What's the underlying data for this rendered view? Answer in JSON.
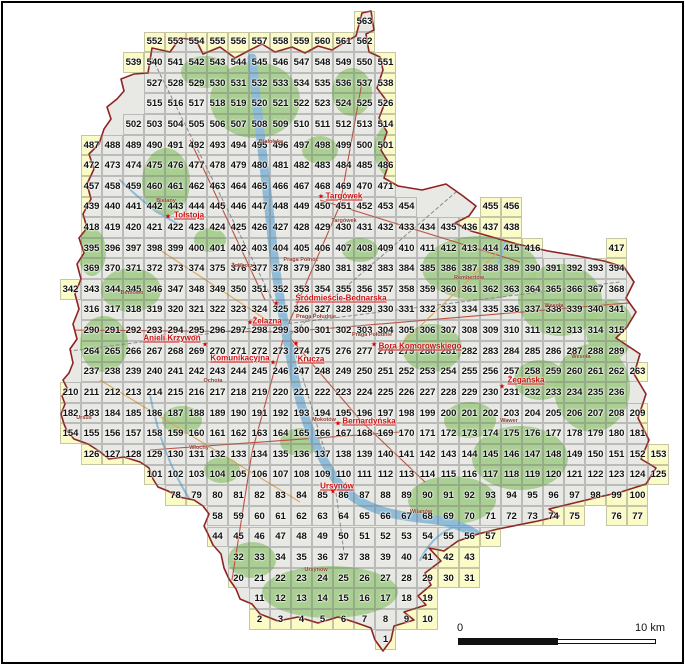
{
  "colors": {
    "cell_yellow": "#fbfbc5",
    "urban_gray": "#e8e8e4",
    "forest_green": "#a3cc8a",
    "water_blue": "#8fbcd9",
    "city_boundary_red": "#8e2323",
    "road_red": "#c05040",
    "road_orange": "#dfa85f",
    "rail_gray": "#8a8a8a",
    "street_label_red": "#cc1111",
    "district_label_brown": "#8f3b2f",
    "number_black": "#111111",
    "frame_black": "#000000"
  },
  "grid": {
    "rows": [
      {
        "segs": [
          [
            563,
            14,
            1
          ]
        ]
      },
      {
        "segs": [
          [
            552,
            4,
            11
          ]
        ]
      },
      {
        "segs": [
          [
            539,
            3,
            13
          ]
        ]
      },
      {
        "segs": [
          [
            527,
            4,
            12
          ]
        ]
      },
      {
        "segs": [
          [
            515,
            4,
            12
          ]
        ]
      },
      {
        "segs": [
          [
            502,
            3,
            13
          ]
        ]
      },
      {
        "segs": [
          [
            487,
            1,
            15
          ]
        ]
      },
      {
        "segs": [
          [
            472,
            1,
            15
          ]
        ]
      },
      {
        "segs": [
          [
            457,
            1,
            15
          ]
        ]
      },
      {
        "segs": [
          [
            439,
            1,
            16
          ],
          [
            455,
            20,
            2
          ]
        ]
      },
      {
        "segs": [
          [
            418,
            1,
            21
          ]
        ]
      },
      {
        "segs": [
          [
            395,
            1,
            22
          ],
          [
            417,
            26,
            1
          ]
        ]
      },
      {
        "segs": [
          [
            369,
            1,
            26
          ]
        ]
      },
      {
        "segs": [
          [
            342,
            0,
            27
          ]
        ]
      },
      {
        "segs": [
          [
            316,
            1,
            26
          ]
        ]
      },
      {
        "segs": [
          [
            290,
            1,
            26
          ]
        ]
      },
      {
        "segs": [
          [
            264,
            1,
            26
          ]
        ]
      },
      {
        "segs": [
          [
            237,
            1,
            27
          ]
        ]
      },
      {
        "segs": [
          [
            210,
            0,
            27
          ]
        ]
      },
      {
        "segs": [
          [
            182,
            0,
            28
          ]
        ]
      },
      {
        "segs": [
          [
            154,
            0,
            28
          ]
        ]
      },
      {
        "segs": [
          [
            126,
            1,
            28
          ]
        ]
      },
      {
        "segs": [
          [
            101,
            4,
            25
          ]
        ]
      },
      {
        "segs": [
          [
            78,
            5,
            23
          ]
        ]
      },
      {
        "segs": [
          [
            58,
            7,
            18
          ],
          [
            76,
            26,
            2
          ]
        ]
      },
      {
        "segs": [
          [
            44,
            7,
            14
          ]
        ]
      },
      {
        "segs": [
          [
            32,
            8,
            12
          ]
        ]
      },
      {
        "segs": [
          [
            20,
            8,
            12
          ]
        ]
      },
      {
        "segs": [
          [
            11,
            9,
            9
          ]
        ]
      },
      {
        "segs": [
          [
            2,
            9,
            9
          ]
        ]
      },
      {
        "segs": [
          [
            1,
            15,
            1
          ]
        ]
      }
    ]
  },
  "street_labels": [
    {
      "text": "Tołstoja",
      "x": 189,
      "y": 215,
      "star": [
        168,
        217
      ]
    },
    {
      "text": "Targówek",
      "x": 344,
      "y": 196,
      "star": [
        321,
        197
      ]
    },
    {
      "text": "Śródmieście-Bednarska",
      "x": 341,
      "y": 298,
      "star": [
        276,
        304
      ]
    },
    {
      "text": "Żelazna",
      "x": 267,
      "y": 321,
      "star": [
        250,
        323
      ]
    },
    {
      "text": "Anieli Krzywoń",
      "x": 172,
      "y": 338,
      "star": [
        205,
        345
      ]
    },
    {
      "text": "Komunikacyjna",
      "x": 240,
      "y": 358,
      "star": [
        273,
        363
      ]
    },
    {
      "text": "Krucza",
      "x": 311,
      "y": 359,
      "star": [
        296,
        344
      ]
    },
    {
      "text": "Bora Komorowskiego",
      "x": 420,
      "y": 346,
      "star": [
        374,
        345
      ]
    },
    {
      "text": "Żegańska",
      "x": 526,
      "y": 380,
      "star": [
        502,
        387
      ]
    },
    {
      "text": "Bernardyńska",
      "x": 369,
      "y": 421,
      "star": [
        338,
        424
      ]
    },
    {
      "text": "Ursynów",
      "x": 337,
      "y": 486,
      "star": [
        333,
        492
      ]
    }
  ],
  "district_labels": [
    {
      "text": "Białołęka",
      "x": 271,
      "y": 142
    },
    {
      "text": "Bielany",
      "x": 166,
      "y": 201
    },
    {
      "text": "Targówek",
      "x": 344,
      "y": 221
    },
    {
      "text": "Żoliborz",
      "x": 242,
      "y": 266
    },
    {
      "text": "Praga Północ",
      "x": 301,
      "y": 260
    },
    {
      "text": "Bemowo",
      "x": 132,
      "y": 293
    },
    {
      "text": "Rembertów",
      "x": 469,
      "y": 278
    },
    {
      "text": "Wesoła",
      "x": 554,
      "y": 306
    },
    {
      "text": "Praga Południe",
      "x": 316,
      "y": 317
    },
    {
      "text": "Praga Południe",
      "x": 372,
      "y": 335
    },
    {
      "text": "Wesoła",
      "x": 581,
      "y": 357
    },
    {
      "text": "Ochota",
      "x": 213,
      "y": 381
    },
    {
      "text": "Ursus",
      "x": 84,
      "y": 418
    },
    {
      "text": "Mokotów",
      "x": 324,
      "y": 420
    },
    {
      "text": "Wawer",
      "x": 509,
      "y": 421
    },
    {
      "text": "Włochy",
      "x": 199,
      "y": 448
    },
    {
      "text": "Wilanów",
      "x": 421,
      "y": 512
    },
    {
      "text": "Ursynów",
      "x": 316,
      "y": 570
    }
  ],
  "scale_bar": {
    "start_label": "0",
    "end_label": "10 km"
  }
}
